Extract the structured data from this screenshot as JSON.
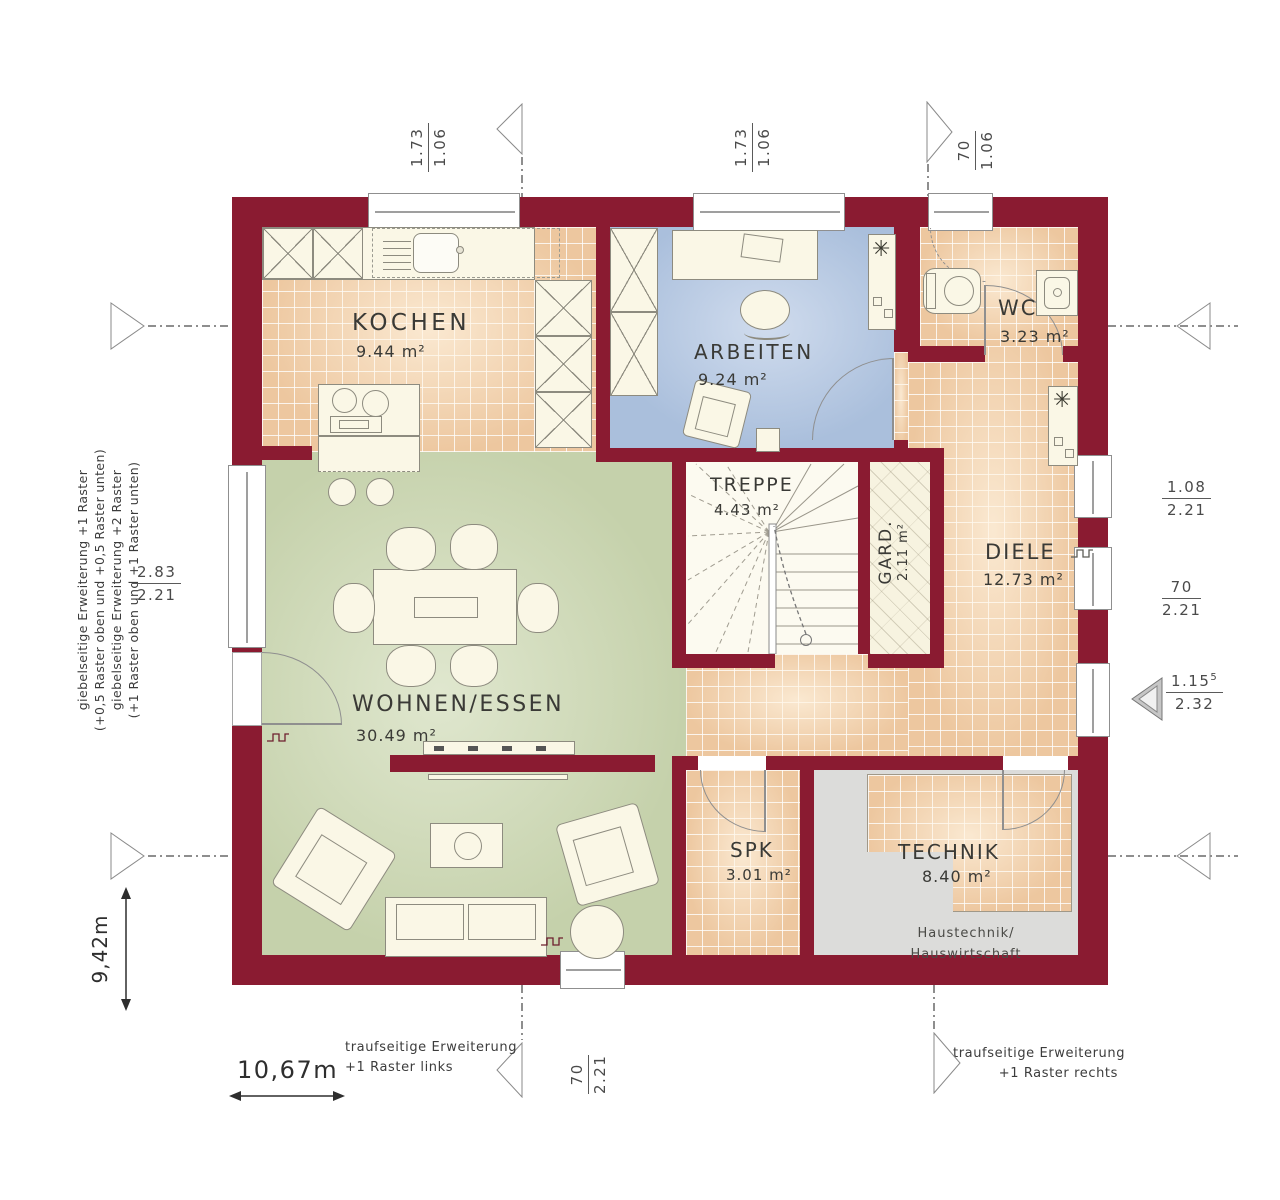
{
  "rooms": {
    "kochen": {
      "name": "KOCHEN",
      "area": "9.44 m²"
    },
    "arbeiten": {
      "name": "ARBEITEN",
      "area": "9.24 m²"
    },
    "wc": {
      "name": "WC",
      "area": "3.23 m²"
    },
    "treppe": {
      "name": "TREPPE",
      "area": "4.43 m²"
    },
    "gard": {
      "name": "GARD.",
      "area": "2.11 m²"
    },
    "diele": {
      "name": "DIELE",
      "area": "12.73 m²"
    },
    "wohnen": {
      "name": "WOHNEN/ESSEN",
      "area": "30.49 m²"
    },
    "spk": {
      "name": "SPK",
      "area": "3.01 m²"
    },
    "technik": {
      "name": "TECHNIK",
      "area": "8.40 m²",
      "note1": "Haustechnik/",
      "note2": "Hauswirtschaft"
    }
  },
  "dims": {
    "top_left": {
      "num": "1.73",
      "den": "1.06"
    },
    "top_mid": {
      "num": "1.73",
      "den": "1.06"
    },
    "top_right": {
      "num": "70",
      "den": "1.06"
    },
    "left": {
      "num": "2.83",
      "den": "2.21"
    },
    "right1": {
      "num": "1.08",
      "den": "2.21"
    },
    "right2": {
      "num": "70",
      "den": "2.21"
    },
    "right3": {
      "num": "1.15",
      "sup": "5",
      "den": "2.32"
    },
    "bottom": {
      "num": "70",
      "den": "2.21"
    },
    "total_width": "10,67m",
    "total_height": "9,42m"
  },
  "annotations": {
    "left_line1": "giebelseitige Erweiterung +1 Raster",
    "left_line2": "(+0,5 Raster oben und +0,5 Raster unten)",
    "left_line3": "giebelseitige Erweiterung +2 Raster",
    "left_line4": "(+1 Raster oben und +1 Raster unten)",
    "bottom_left_line1": "traufseitige Erweiterung",
    "bottom_left_line2": "+1 Raster links",
    "bottom_right_line1": "traufseitige Erweiterung",
    "bottom_right_line2": "+1 Raster rechts"
  },
  "icons": {
    "plant": "✳"
  },
  "colors": {
    "wall": "#8a1b31",
    "tile": "#edc79f",
    "living": "#c5d1ab",
    "arbeiten": "#aabfdc",
    "technik": "#dcdcda"
  }
}
